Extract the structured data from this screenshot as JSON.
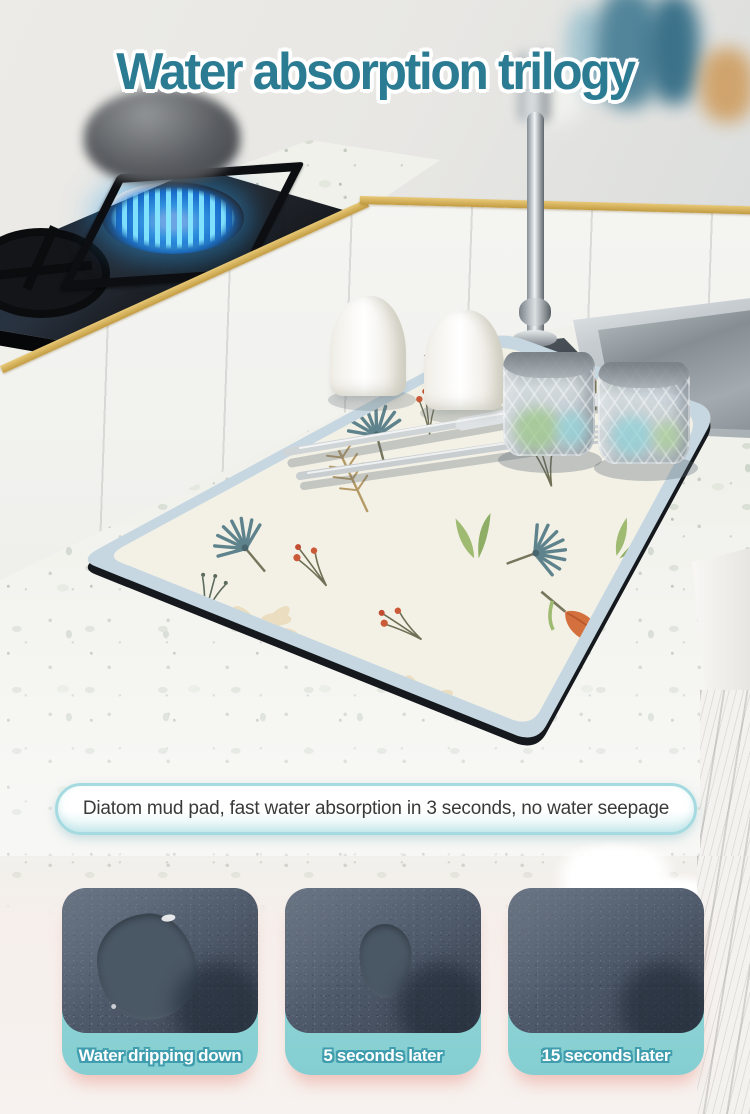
{
  "page": {
    "title": "Water absorption trilogy"
  },
  "banner": {
    "text": "Diatom mud pad, fast water absorption in 3 seconds, no water seepage"
  },
  "steps": [
    {
      "label": "Water dripping down",
      "state": "large water puddle on pad"
    },
    {
      "label": "5 seconds later",
      "state": "small water puddle remaining"
    },
    {
      "label": "15 seconds later",
      "state": "water fully absorbed, pad dry"
    }
  ],
  "colors": {
    "title_color": "#2b7c92",
    "label_outline": "#3f9dae",
    "banner_border": "#a5dbe0",
    "gold_trim": "#d7b55e",
    "mat_border": "#c6d7e1",
    "card_teal_1": "#9cdadb",
    "card_teal_2": "#84ced1",
    "flame_blue": "#2bb3ea",
    "puddle_color": "#4a5765",
    "bottom_bg": "#f5eeea"
  }
}
